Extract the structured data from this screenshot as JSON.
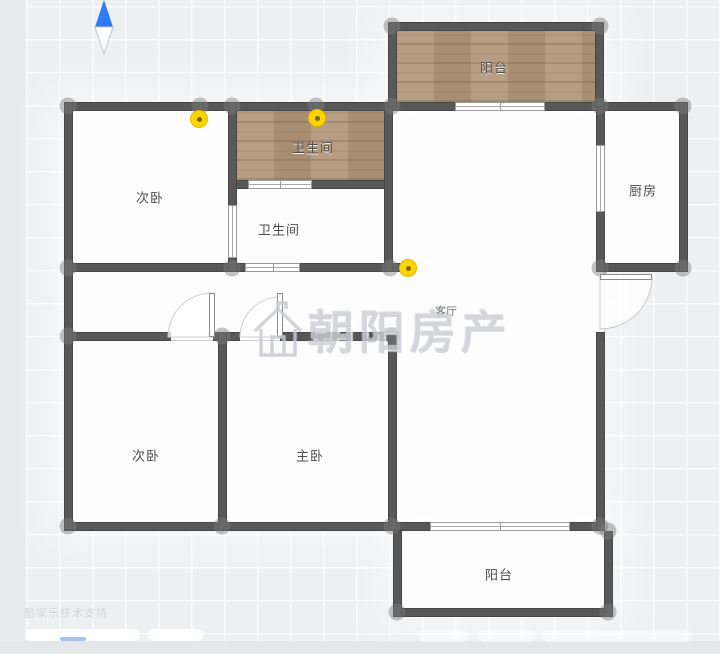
{
  "app": {
    "watermark_text": "朝阳房产",
    "support_text": "酷家乐技术支持"
  },
  "rooms": [
    {
      "id": "balcony-top",
      "label": "阳台",
      "floor": "wood"
    },
    {
      "id": "bathroom-wood",
      "label": "卫生间",
      "floor": "wood"
    },
    {
      "id": "bedroom-top",
      "label": "次卧",
      "floor": "white"
    },
    {
      "id": "bathroom-white",
      "label": "卫生间",
      "floor": "white"
    },
    {
      "id": "kitchen",
      "label": "厨房",
      "floor": "white"
    },
    {
      "id": "living-room",
      "label": "客厅",
      "floor": "white"
    },
    {
      "id": "bedroom-bottom",
      "label": "次卧",
      "floor": "white"
    },
    {
      "id": "master-bedroom",
      "label": "主卧",
      "floor": "white"
    },
    {
      "id": "balcony-bottom",
      "label": "阳台",
      "floor": "white"
    }
  ],
  "markers": {
    "count": 3,
    "type": "panorama-point"
  },
  "colors": {
    "wall": "#585858",
    "wood_floor": "#b2977a",
    "marker_yellow": "#ffd400",
    "compass_blue": "#2f7bf6",
    "canvas": "#edeff1"
  }
}
